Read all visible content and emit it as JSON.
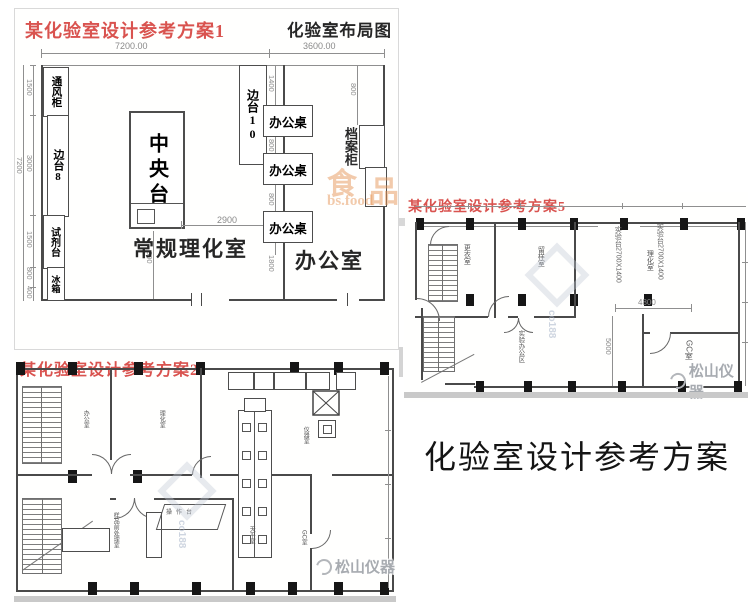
{
  "page": {
    "heading": "化验室设计参考方案",
    "background": "#ffffff"
  },
  "colors": {
    "title_red": "#d9534f",
    "wall": "#4a4a4a",
    "dim_gray": "#8a8a8a",
    "watermark_orange": "#e6995c",
    "watermark_gray": "#a7abb0"
  },
  "plan1": {
    "title": "某化验室设计参考方案1",
    "subtitle": "化验室布局图",
    "dims": {
      "top_left": "7200.00",
      "top_right": "3600.00",
      "overall_left": "7200",
      "left_chain": [
        "1500",
        "3000",
        "1500",
        "800",
        "400"
      ],
      "central_width": "2900",
      "central_south": "800",
      "desk_chain": [
        "1400",
        "800",
        "800",
        "1800"
      ],
      "cabinet_north": "800"
    },
    "furniture": {
      "fume_hood": "通风柜",
      "side_bench_8": "边台8",
      "reagent_bench": "试剂台",
      "fridge": "冰箱",
      "central_bench": "中央台",
      "side_bench_10": "边台10",
      "desks": [
        "办公桌",
        "办公桌",
        "办公桌"
      ],
      "file_cabinet": "档案柜"
    },
    "rooms": {
      "lab": "常规理化室",
      "office": "办公室"
    },
    "watermark": {
      "char_a": "食",
      "char_b": "品",
      "url": "bs.food"
    }
  },
  "plan2": {
    "title": "某化验室设计参考方案2",
    "rooms": {
      "a": "办公室",
      "b": "理化室",
      "c": "仪器室",
      "d": "样品前处理室",
      "e": "天平室",
      "f": "GC室",
      "bench": "操作台"
    }
  },
  "plan5": {
    "title": "某化验室设计参考方案5",
    "rooms": {
      "a": "更衣室",
      "b": "留样室",
      "c": "理化室",
      "d": "实验办公区",
      "e": "GC室"
    },
    "bench_note_a": "实验台2700X1400",
    "bench_note_b": "实验台2700X1400",
    "dims": {
      "width": "4800",
      "height": "5000"
    }
  },
  "watermarks": {
    "songshan": "松山仪器",
    "co188": "co188"
  }
}
